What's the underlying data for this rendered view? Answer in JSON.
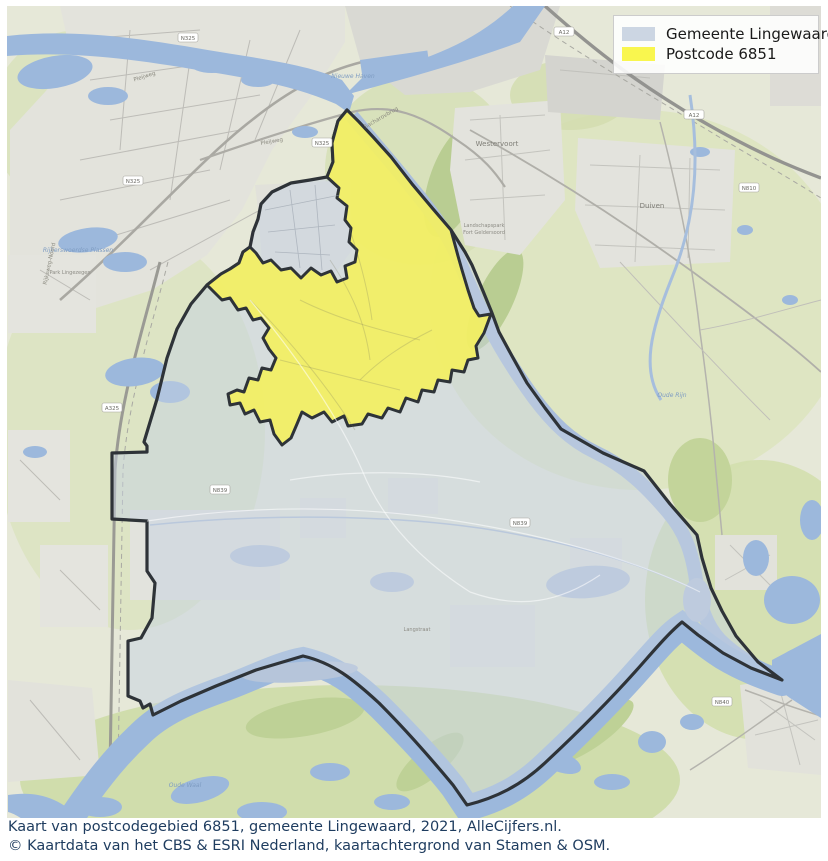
{
  "legend": {
    "items": [
      {
        "label": "Gemeente Lingewaard",
        "color": "#ccd6e3"
      },
      {
        "label": "Postcode 6851",
        "color": "#f9f64e"
      }
    ]
  },
  "caption": {
    "line1": "Kaart van postcodegebied 6851, gemeente Lingewaard, 2021, AlleCijfers.nl.",
    "line2": "© Kaartdata van het CBS & ESRI Nederland, kaartachtergrond van Stamen & OSM."
  },
  "map": {
    "colors": {
      "municipality_fill": "rgba(197,209,225,0.5)",
      "municipality_stroke": "#2e3338",
      "postcode_fill": "#f4f05e",
      "water_bright": "#9cb8dc",
      "water_muted": "#b6c5da",
      "land": "#e6e8d8",
      "urban": "#e3e3dc"
    },
    "regions": {
      "municipality_name": "Gemeente Lingewaard",
      "postcode_name": "Postcode 6851"
    },
    "labels": [
      {
        "text": "Westervoort",
        "x": 497,
        "y": 146,
        "cls": "town",
        "rot": 0
      },
      {
        "text": "Duiven",
        "x": 652,
        "y": 208,
        "cls": "town",
        "rot": 0
      },
      {
        "text": "Nieuwe Haven",
        "x": 353,
        "y": 78,
        "cls": "water",
        "rot": 0
      },
      {
        "text": "Sacharovbrug",
        "x": 382,
        "y": 119,
        "cls": "roadlbl",
        "rot": -30
      },
      {
        "text": "Rijkerswoerdse Plassen",
        "x": 78,
        "y": 252,
        "cls": "water",
        "rot": 0
      },
      {
        "text": "Park Lingezegen",
        "x": 70,
        "y": 274,
        "cls": "small",
        "rot": 0
      },
      {
        "text": "Pleijweg",
        "x": 145,
        "y": 78,
        "cls": "roadlbl",
        "rot": -18
      },
      {
        "text": "Pleijweg",
        "x": 272,
        "y": 143,
        "cls": "roadlbl",
        "rot": -10
      },
      {
        "text": "Rijksweg-Noord",
        "x": 51,
        "y": 264,
        "cls": "roadlbl",
        "rot": -78
      },
      {
        "text": "Landschapspark",
        "x": 484,
        "y": 227,
        "cls": "small",
        "rot": 0
      },
      {
        "text": "Fort Geldersoord",
        "x": 484,
        "y": 234,
        "cls": "small",
        "rot": 0
      },
      {
        "text": "Langstraat",
        "x": 417,
        "y": 631,
        "cls": "small",
        "rot": 0
      },
      {
        "text": "Oude Rijn",
        "x": 672,
        "y": 397,
        "cls": "water",
        "rot": 0
      },
      {
        "text": "Oude Waal",
        "x": 185,
        "y": 787,
        "cls": "water",
        "rot": 0
      }
    ],
    "road_shields": [
      {
        "label": "N325",
        "x": 188,
        "y": 38
      },
      {
        "label": "N325",
        "x": 133,
        "y": 181
      },
      {
        "label": "N325",
        "x": 322,
        "y": 143
      },
      {
        "label": "A325",
        "x": 112,
        "y": 408
      },
      {
        "label": "A12",
        "x": 564,
        "y": 32
      },
      {
        "label": "A12",
        "x": 694,
        "y": 115
      },
      {
        "label": "N810",
        "x": 749,
        "y": 188
      },
      {
        "label": "N839",
        "x": 220,
        "y": 490
      },
      {
        "label": "N839",
        "x": 520,
        "y": 523
      },
      {
        "label": "N840",
        "x": 722,
        "y": 702
      }
    ]
  }
}
